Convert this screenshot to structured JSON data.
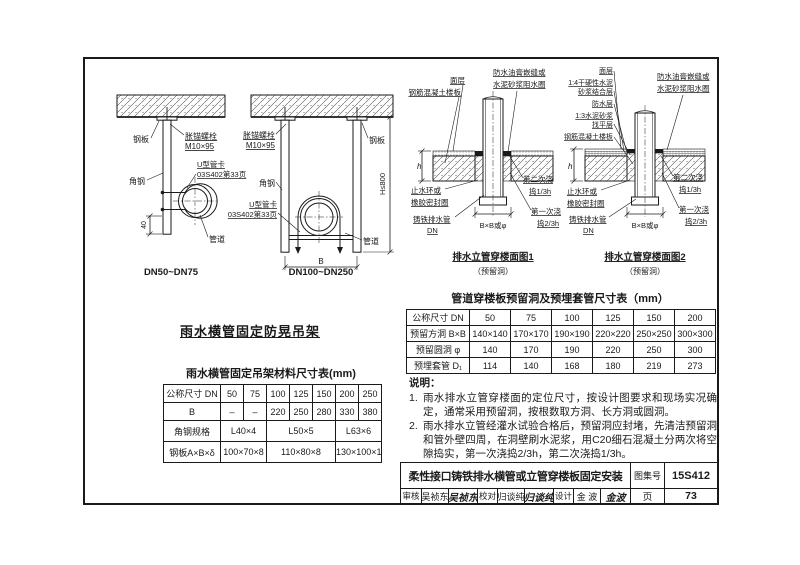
{
  "colors": {
    "ink": "#1a1a1a",
    "paper": "#ffffff"
  },
  "hanger": {
    "section_title": "雨水横管固定防晃吊架",
    "small": {
      "caption": "DN50~DN75",
      "steel_plate": "钢板",
      "bolt_line1": "胀锚螺栓",
      "bolt_line2": "M10×95",
      "angle": "角钢",
      "clamp_line1": "U型管卡",
      "clamp_line2": "03S402第33页",
      "pipe": "管道",
      "dim_40": "40"
    },
    "large": {
      "caption": "DN100~DN250",
      "steel_plate": "钢板",
      "bolt_line1": "胀锚螺栓",
      "bolt_line2": "M10×95",
      "angle": "角钢",
      "clamp_line1": "U型管卡",
      "clamp_line2": "03S402第33页",
      "pipe": "管道",
      "dim_b": "B",
      "dim_h": "H≤800"
    }
  },
  "hanger_table": {
    "title": "雨水横管固定吊架材料尺寸表(mm)",
    "header": [
      "公称尺寸 DN",
      "50",
      "75",
      "100",
      "125",
      "150",
      "200",
      "250"
    ],
    "row_b": [
      "B",
      "–",
      "–",
      "220",
      "250",
      "280",
      "330",
      "380"
    ],
    "row_angle": [
      "角钢规格",
      "L40×4",
      "L50×5",
      "L63×6"
    ],
    "row_plate": [
      "钢板A×B×δ",
      "100×70×8",
      "110×80×8",
      "130×100×10"
    ]
  },
  "details": {
    "d1": {
      "title": "排水立管穿楼面图1",
      "subtitle": "（预留洞）",
      "surface": "面层",
      "slab": "钢筋混凝土楼板",
      "ring1": "防水油膏嵌缝或",
      "ring2": "水泥砂浆阻水圈",
      "stop1": "止水环或",
      "stop2": "橡胶密封圈",
      "pipe1": "铸铁排水管",
      "pipe2": "DN",
      "hole": "B×B或φ",
      "pour2a": "第二次浇",
      "pour2b": "捣1/3h",
      "pour1a": "第一次浇",
      "pour1b": "捣2/3h",
      "dimh": "h"
    },
    "d2": {
      "title": "排水立管穿楼面图2",
      "subtitle": "（预留洞）",
      "surface": "面层",
      "bond1": "1:4干硬性水泥",
      "bond2": "砂浆结合层",
      "wp": "防水层",
      "level1": "1:3水泥砂浆",
      "level2": "找平层",
      "slab": "钢筋混凝土楼板",
      "ring1": "防水油膏嵌缝或",
      "ring2": "水泥砂浆阻水圈",
      "stop1": "止水环或",
      "stop2": "橡胶密封圈",
      "pipe1": "铸铁排水管",
      "pipe2": "DN",
      "hole": "B×B或φ",
      "pour2a": "第二次浇",
      "pour2b": "捣1/3h",
      "pour1a": "第一次浇",
      "pour1b": "捣2/3h",
      "dimh": "h"
    }
  },
  "sleeve_table": {
    "title": "管道穿楼板预留洞及预埋套管尺寸表（mm）",
    "rows": [
      [
        "公称尺寸 DN",
        "50",
        "75",
        "100",
        "125",
        "150",
        "200"
      ],
      [
        "预留方洞 B×B",
        "140×140",
        "170×170",
        "190×190",
        "220×220",
        "250×250",
        "300×300"
      ],
      [
        "预留圆洞 φ",
        "140",
        "170",
        "190",
        "220",
        "250",
        "300"
      ],
      [
        "预埋套管 D₁",
        "114",
        "140",
        "168",
        "180",
        "219",
        "273"
      ]
    ]
  },
  "notes": {
    "heading": "说明：",
    "items": [
      {
        "num": "1.",
        "text": "雨水排水立管穿楼面的定位尺寸，按设计图要求和现场实况确定，通常采用预留洞，按根数取方洞、长方洞或圆洞。"
      },
      {
        "num": "2.",
        "text": "雨水排水立管经灌水试验合格后，预留洞应封堵，先清洁预留洞和管外壁四周，在洞壁刷水泥浆，用C20细石混凝土分两次将空隙捣实，第一次浇捣2/3h，第二次浇捣1/3h。"
      }
    ]
  },
  "titleblock": {
    "title": "柔性接口铸铁排水横管或立管穿楼板固定安装",
    "atlas_label": "图集号",
    "atlas_no": "15S412",
    "page_label": "页",
    "page_no": "73",
    "roles": [
      {
        "role": "审核",
        "name": "吴祯东",
        "sig": "吴祯东"
      },
      {
        "role": "校对",
        "name": "归谈纯",
        "sig": "归谈纯"
      },
      {
        "role": "设计",
        "name": "金 波",
        "sig": "金波"
      }
    ]
  }
}
